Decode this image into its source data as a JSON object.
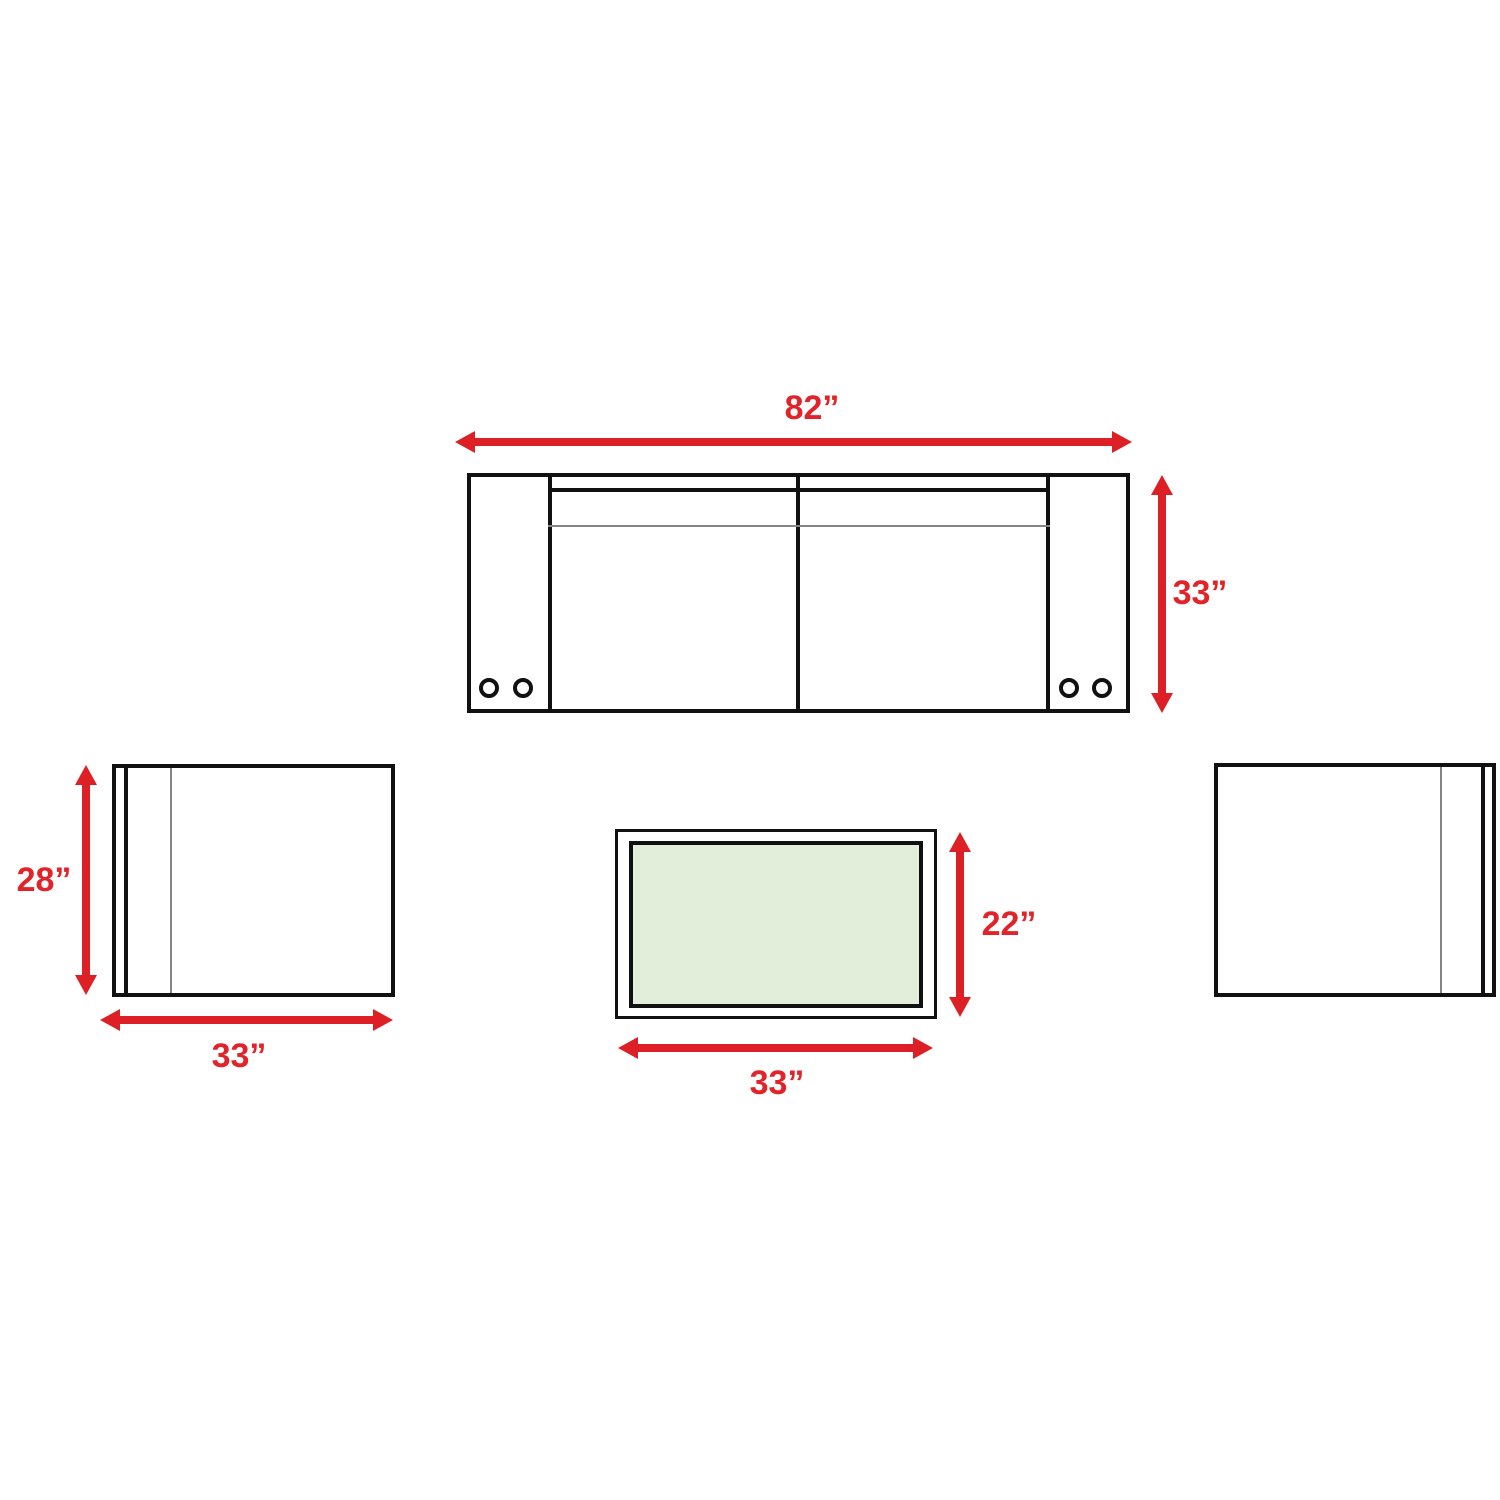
{
  "diagram": {
    "accent_color": "#dd2026",
    "outline_color": "#111111",
    "secondary_line_color": "#858585",
    "table_top_color": "#e3eeda",
    "sofa": {
      "width_label": "82”",
      "depth_label": "33”",
      "width_in": 82,
      "depth_in": 33
    },
    "left_chair": {
      "depth_label": "28”",
      "width_label": "33”",
      "depth_in": 28,
      "width_in": 33
    },
    "coffee_table": {
      "depth_label": "22”",
      "width_label": "33”",
      "depth_in": 22,
      "width_in": 33
    }
  }
}
